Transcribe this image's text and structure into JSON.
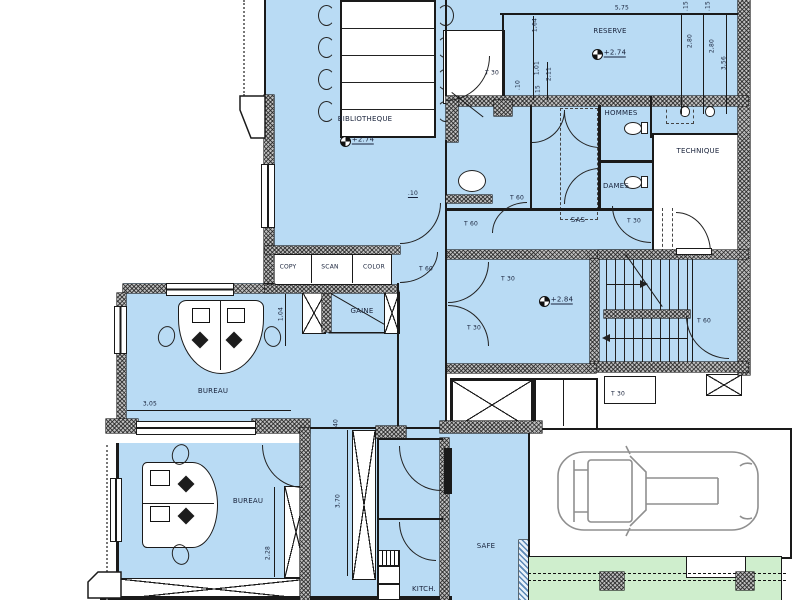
{
  "drawing": {
    "type": "architectural-floor-plan",
    "colors": {
      "room_fill": "#b9dbf4",
      "green_fill": "#cfeecd",
      "wall_gray": "#bfbfbf",
      "line": "#1a1a1a"
    },
    "rooms": {
      "bibliotheque": "BIBLIOTHEQUE",
      "reserve": "RESERVE",
      "hommes": "HOMMES",
      "dames": "DAMES",
      "technique": "TECHNIQUE",
      "sas": "SAS",
      "gaine": "GAINE",
      "bureau_1": "BUREAU",
      "bureau_2": "BUREAU",
      "safe": "SAFE",
      "kitchen": "KITCH."
    },
    "counter": {
      "copy": "COPY",
      "scan": "SCAN",
      "color": "COLOR"
    },
    "elevations": {
      "bibliotheque": "+2.74",
      "reserve": "+2.74",
      "hall": "+2.84"
    },
    "door_tags": [
      "T 30",
      "T 60",
      "T 60",
      "T 30",
      "T 60",
      "T 30",
      "T 30",
      "T 60",
      "T 30"
    ],
    "dimensions": [
      "5,75",
      ".15",
      ".15",
      "1,64",
      "1,01",
      "2,11",
      ".15",
      ".10",
      "2,80",
      "2,80",
      "3,56",
      ".10",
      "1,04",
      "3,05",
      "2,28",
      ".40",
      "3,70"
    ]
  }
}
